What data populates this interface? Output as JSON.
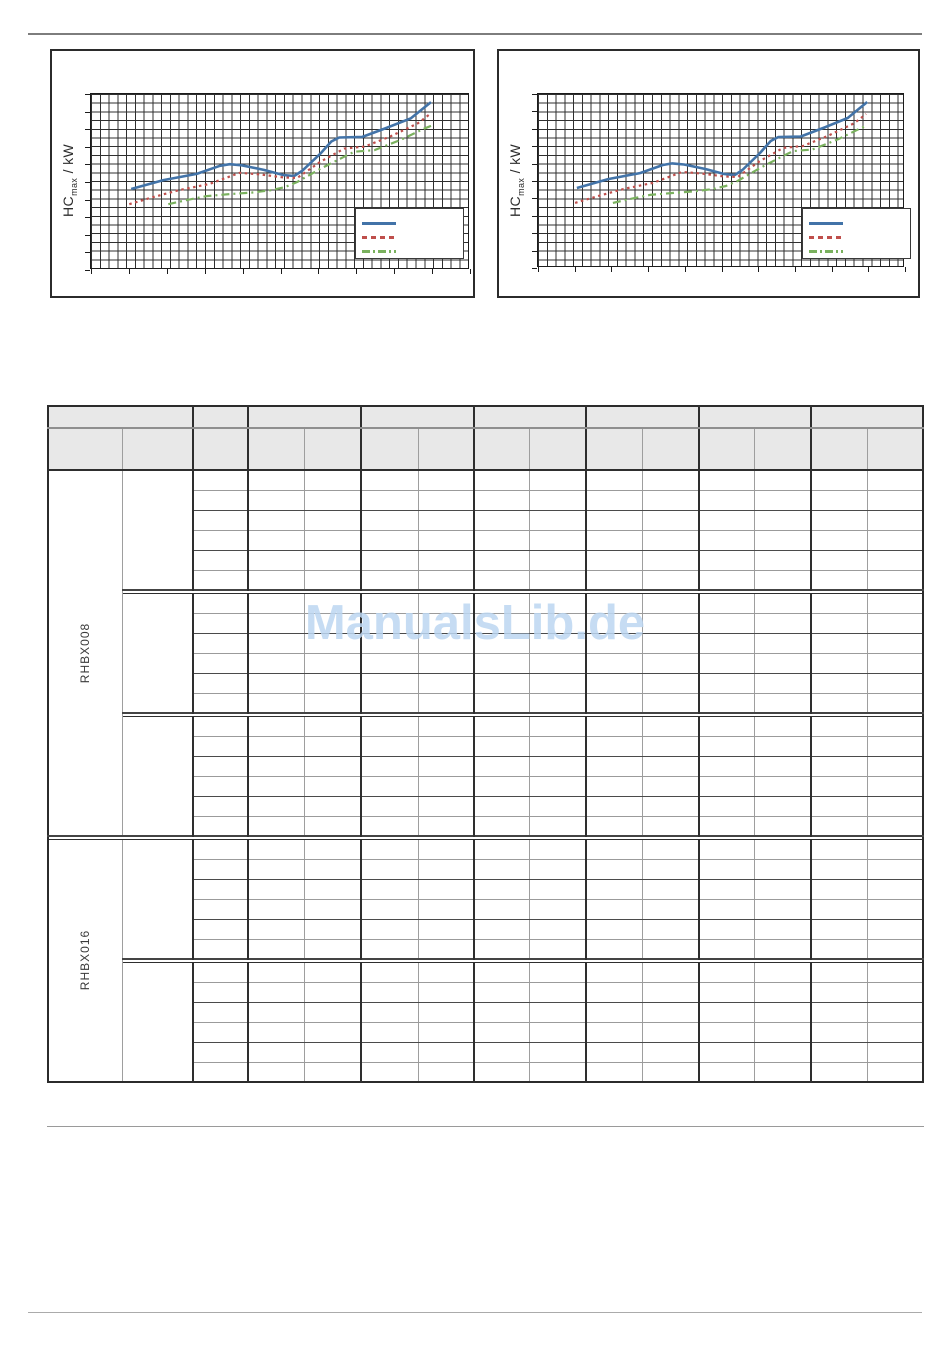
{
  "colors": {
    "series_blue": "#4273a8",
    "series_red": "#bf4f4c",
    "series_green": "#7ab15e",
    "header_fill": "#e8e8e8",
    "watermark_blue": "#bdd7f2"
  },
  "charts": [
    {
      "id": "left",
      "ylabel": {
        "main": "HC",
        "sub": "max",
        "rest": " / kW"
      }
    },
    {
      "id": "right",
      "ylabel": {
        "main": "HC",
        "sub": "max",
        "rest": " / kW"
      }
    }
  ],
  "chart_data": [
    {
      "type": "line",
      "title": "",
      "xlabel": "",
      "ylabel": "HC_max / kW",
      "tick_labels_visible": false,
      "grid": "fine square grid, on",
      "legend_position": "bottom-right",
      "legend_labels_visible": false,
      "x_range_normalized": [
        0,
        1
      ],
      "y_range_normalized": [
        0,
        1
      ],
      "series": [
        {
          "name": "blue-solid",
          "label": "",
          "style": "solid",
          "color": "#4273a8",
          "stroke_width": 2.6,
          "dash": "",
          "points_normalized": [
            [
              0.106,
              0.54
            ],
            [
              0.191,
              0.489
            ],
            [
              0.279,
              0.454
            ],
            [
              0.34,
              0.408
            ],
            [
              0.366,
              0.399
            ],
            [
              0.398,
              0.405
            ],
            [
              0.456,
              0.431
            ],
            [
              0.507,
              0.46
            ],
            [
              0.536,
              0.466
            ],
            [
              0.557,
              0.437
            ],
            [
              0.605,
              0.339
            ],
            [
              0.634,
              0.27
            ],
            [
              0.655,
              0.247
            ],
            [
              0.716,
              0.244
            ],
            [
              0.783,
              0.19
            ],
            [
              0.844,
              0.138
            ],
            [
              0.897,
              0.046
            ]
          ]
        },
        {
          "name": "red-dotted",
          "label": "",
          "style": "dotted",
          "color": "#bf4f4c",
          "stroke_width": 2.2,
          "dash": "2.5 3.5",
          "points_normalized": [
            [
              0.101,
              0.626
            ],
            [
              0.164,
              0.586
            ],
            [
              0.233,
              0.546
            ],
            [
              0.313,
              0.511
            ],
            [
              0.393,
              0.448
            ],
            [
              0.446,
              0.457
            ],
            [
              0.507,
              0.474
            ],
            [
              0.544,
              0.477
            ],
            [
              0.605,
              0.385
            ],
            [
              0.668,
              0.31
            ],
            [
              0.722,
              0.299
            ],
            [
              0.79,
              0.241
            ],
            [
              0.862,
              0.167
            ],
            [
              0.894,
              0.115
            ]
          ]
        },
        {
          "name": "green-dashdot",
          "label": "",
          "style": "dash-dot",
          "color": "#7ab15e",
          "stroke_width": 2.2,
          "dash": "8 4 2 4",
          "points_normalized": [
            [
              0.204,
              0.626
            ],
            [
              0.252,
              0.603
            ],
            [
              0.305,
              0.58
            ],
            [
              0.366,
              0.569
            ],
            [
              0.424,
              0.56
            ],
            [
              0.477,
              0.546
            ],
            [
              0.512,
              0.529
            ],
            [
              0.544,
              0.5
            ],
            [
              0.605,
              0.425
            ],
            [
              0.668,
              0.356
            ],
            [
              0.695,
              0.328
            ],
            [
              0.748,
              0.319
            ],
            [
              0.817,
              0.261
            ],
            [
              0.881,
              0.195
            ],
            [
              0.897,
              0.181
            ]
          ]
        }
      ]
    },
    {
      "type": "line",
      "title": "",
      "xlabel": "",
      "ylabel": "HC_max / kW",
      "tick_labels_visible": false,
      "grid": "fine square grid, on",
      "legend_position": "bottom-right",
      "legend_labels_visible": false,
      "x_range_normalized": [
        0,
        1
      ],
      "y_range_normalized": [
        0,
        1
      ],
      "series": [
        {
          "name": "blue-solid",
          "label": "",
          "style": "solid",
          "color": "#4273a8",
          "stroke_width": 2.6,
          "dash": "",
          "points_normalized": [
            [
              0.106,
              0.54
            ],
            [
              0.191,
              0.489
            ],
            [
              0.279,
              0.454
            ],
            [
              0.34,
              0.408
            ],
            [
              0.366,
              0.399
            ],
            [
              0.398,
              0.405
            ],
            [
              0.456,
              0.431
            ],
            [
              0.507,
              0.46
            ],
            [
              0.536,
              0.466
            ],
            [
              0.557,
              0.437
            ],
            [
              0.605,
              0.339
            ],
            [
              0.634,
              0.27
            ],
            [
              0.655,
              0.247
            ],
            [
              0.716,
              0.244
            ],
            [
              0.783,
              0.19
            ],
            [
              0.844,
              0.138
            ],
            [
              0.897,
              0.046
            ]
          ]
        },
        {
          "name": "red-dotted",
          "label": "",
          "style": "dotted",
          "color": "#bf4f4c",
          "stroke_width": 2.2,
          "dash": "2.5 3.5",
          "points_normalized": [
            [
              0.101,
              0.626
            ],
            [
              0.164,
              0.586
            ],
            [
              0.233,
              0.546
            ],
            [
              0.313,
              0.511
            ],
            [
              0.393,
              0.448
            ],
            [
              0.446,
              0.457
            ],
            [
              0.507,
              0.474
            ],
            [
              0.544,
              0.477
            ],
            [
              0.605,
              0.385
            ],
            [
              0.668,
              0.31
            ],
            [
              0.722,
              0.299
            ],
            [
              0.79,
              0.241
            ],
            [
              0.862,
              0.167
            ],
            [
              0.894,
              0.115
            ]
          ]
        },
        {
          "name": "green-dashdot",
          "label": "",
          "style": "dash-dot",
          "color": "#7ab15e",
          "stroke_width": 2.2,
          "dash": "8 4 2 4",
          "points_normalized": [
            [
              0.204,
              0.626
            ],
            [
              0.252,
              0.603
            ],
            [
              0.305,
              0.58
            ],
            [
              0.366,
              0.569
            ],
            [
              0.424,
              0.56
            ],
            [
              0.477,
              0.546
            ],
            [
              0.512,
              0.529
            ],
            [
              0.544,
              0.5
            ],
            [
              0.605,
              0.425
            ],
            [
              0.668,
              0.356
            ],
            [
              0.695,
              0.328
            ],
            [
              0.748,
              0.319
            ],
            [
              0.817,
              0.261
            ],
            [
              0.881,
              0.195
            ],
            [
              0.897,
              0.181
            ]
          ]
        }
      ]
    }
  ],
  "table": {
    "columns_total": 15,
    "data_columns": 13,
    "header_row1_spans": [
      2,
      1,
      2,
      2,
      2,
      2,
      2,
      2
    ],
    "header_cells_empty": true,
    "body_cells_empty": true,
    "rows_per_subgroup": 6,
    "devices": [
      {
        "label": "RHBX008",
        "subgroups": 3
      },
      {
        "label": "RHBX016",
        "subgroups": 2
      }
    ]
  },
  "watermark": {
    "text": "ManualsLib.de"
  }
}
